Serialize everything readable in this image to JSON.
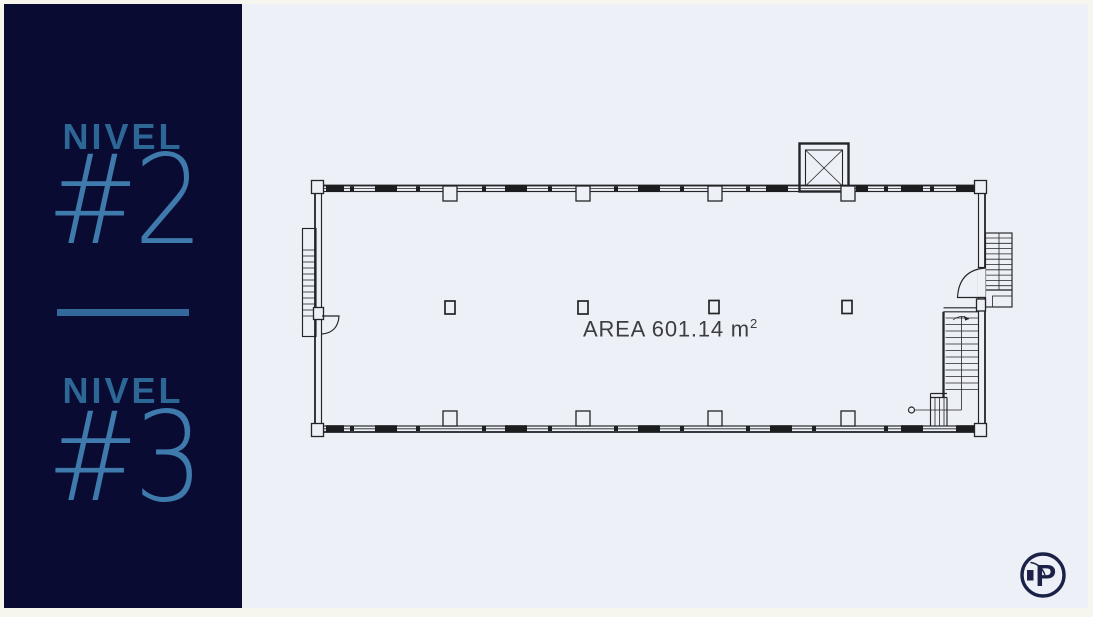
{
  "sidebar": {
    "background": "#0a0b33",
    "label_color": "#2d6796",
    "number_color": "#3e7aab",
    "levels": [
      {
        "label": "NIVEL",
        "number": "#2"
      },
      {
        "label": "NIVEL",
        "number": "#3"
      }
    ]
  },
  "plan": {
    "area_label": "AREA 601.14 m",
    "area_superscript": "2",
    "line_color": "#232527",
    "panel_background": "#edf0f6"
  },
  "logo": {
    "letter": "P",
    "color": "#1b2147"
  }
}
